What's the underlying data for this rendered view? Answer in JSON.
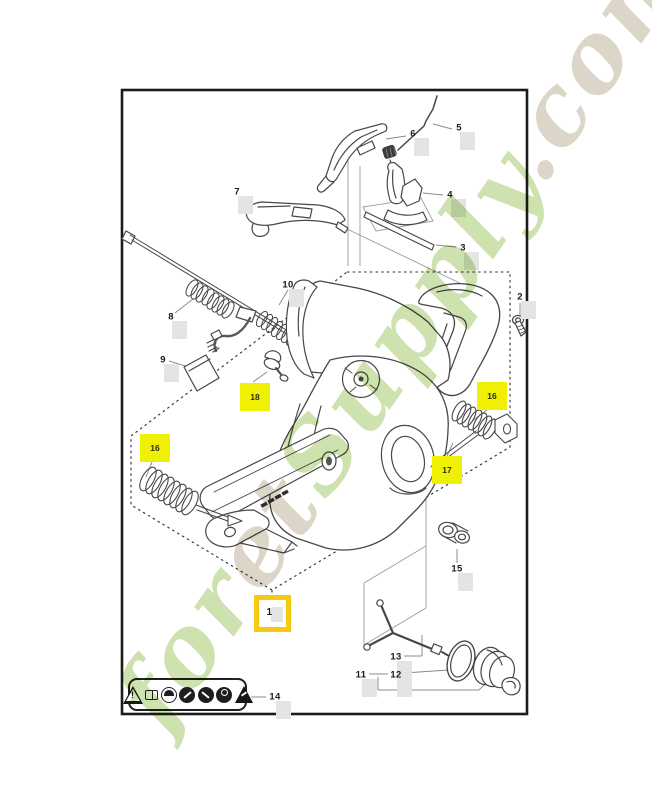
{
  "page": {
    "background": "#ffffff"
  },
  "frame": {
    "stroke_color": "#1c1c1c"
  },
  "colors": {
    "highlight_yellow": "#f0f005",
    "highlight_box_border": "#f6c913",
    "ghost_hotspot": "#e4e4e4",
    "watermark_green": "#a4ca6d",
    "watermark_tan": "#bfb49a",
    "line_dark": "#474747",
    "line_leader": "#8c8c8c"
  },
  "watermark": {
    "parts": [
      {
        "text": "for",
        "color": "#a4ca6d"
      },
      {
        "text": "et",
        "color": "#bfb49a"
      },
      {
        "text": "Supply",
        "color": "#a4ca6d"
      },
      {
        "text": ".com",
        "color": "#bfb49a"
      }
    ]
  },
  "callouts": [
    {
      "id": "1",
      "style": "yellow-outline",
      "x": 272,
      "y": 613
    },
    {
      "id": "2",
      "style": "plain",
      "x": 520,
      "y": 297
    },
    {
      "id": "3",
      "style": "plain",
      "x": 463,
      "y": 248
    },
    {
      "id": "4",
      "style": "plain",
      "x": 450,
      "y": 195
    },
    {
      "id": "5",
      "style": "plain",
      "x": 459,
      "y": 128
    },
    {
      "id": "6",
      "style": "plain",
      "x": 413,
      "y": 134
    },
    {
      "id": "7",
      "style": "plain",
      "x": 237,
      "y": 192
    },
    {
      "id": "8",
      "style": "plain",
      "x": 171,
      "y": 317
    },
    {
      "id": "9",
      "style": "plain",
      "x": 163,
      "y": 360
    },
    {
      "id": "10",
      "style": "plain",
      "x": 288,
      "y": 285
    },
    {
      "id": "11",
      "style": "plain",
      "x": 361,
      "y": 675
    },
    {
      "id": "12",
      "style": "plain",
      "x": 396,
      "y": 675
    },
    {
      "id": "13",
      "style": "plain",
      "x": 396,
      "y": 657
    },
    {
      "id": "14",
      "style": "plain",
      "x": 275,
      "y": 697
    },
    {
      "id": "15",
      "style": "plain",
      "x": 457,
      "y": 569
    },
    {
      "id": "16",
      "style": "yellow-fill",
      "x": 155,
      "y": 448
    },
    {
      "id": "16",
      "style": "yellow-fill",
      "x": 492,
      "y": 396
    },
    {
      "id": "17",
      "style": "yellow-fill",
      "x": 447,
      "y": 470
    },
    {
      "id": "18",
      "style": "yellow-fill",
      "x": 255,
      "y": 397
    }
  ],
  "warning_label": {
    "icons": [
      {
        "name": "warning-triangle-icon",
        "shape": "triangle-outline"
      },
      {
        "name": "read-manual-book-icon",
        "shape": "book"
      },
      {
        "name": "head-protection-icon",
        "shape": "circle-light"
      },
      {
        "name": "hearing-protection-icon",
        "shape": "circle-dark"
      },
      {
        "name": "two-hand-grip-icon",
        "shape": "circle-dark"
      },
      {
        "name": "no-one-hand-icon",
        "shape": "circle-dark"
      },
      {
        "name": "kickback-warning-icon",
        "shape": "triangle-solid"
      }
    ]
  }
}
